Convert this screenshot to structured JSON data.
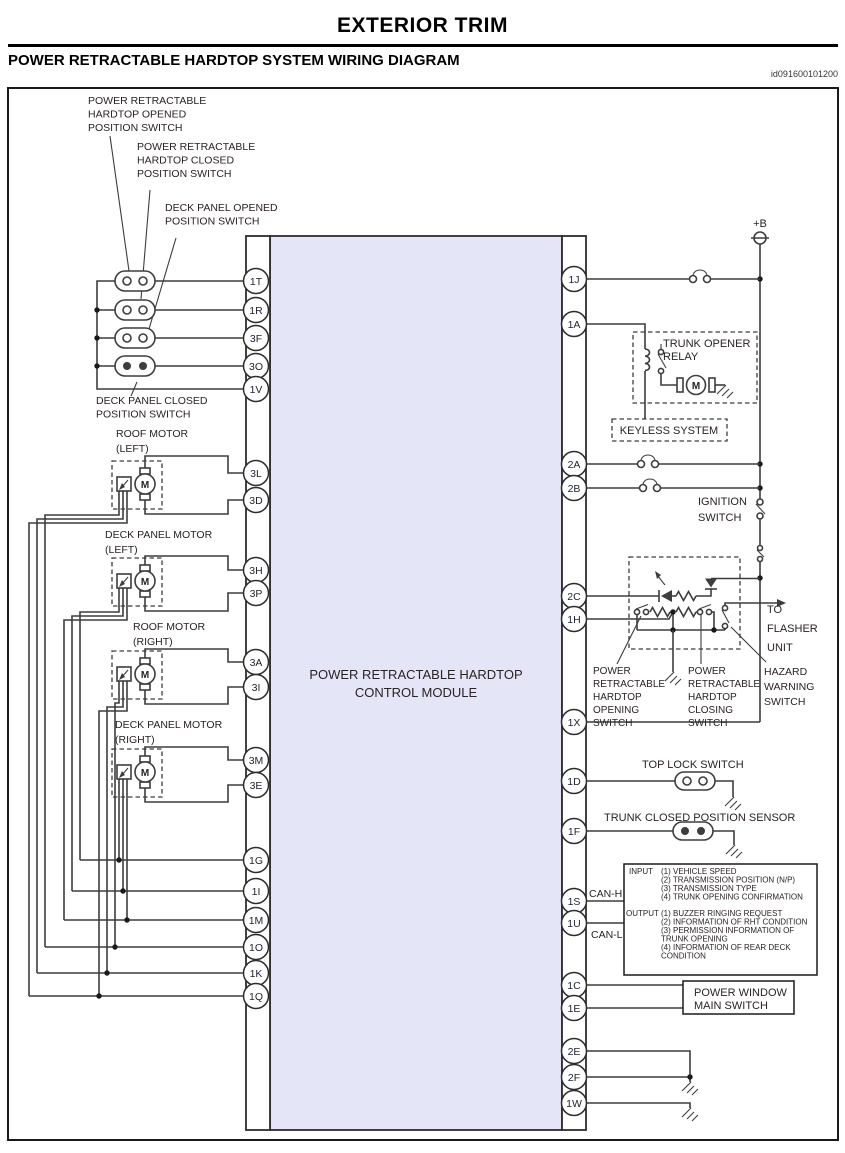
{
  "header": {
    "title": "EXTERIOR TRIM",
    "subtitle": "POWER RETRACTABLE HARDTOP SYSTEM WIRING DIAGRAM",
    "doc_id": "id091600101200"
  },
  "module": {
    "line1": "POWER RETRACTABLE HARDTOP",
    "line2": "CONTROL MODULE"
  },
  "pins": {
    "left": [
      "1T",
      "1R",
      "3F",
      "3O",
      "1V",
      "3L",
      "3D",
      "3H",
      "3P",
      "3A",
      "3I",
      "3M",
      "3E",
      "1G",
      "1I",
      "1M",
      "1O",
      "1K",
      "1Q"
    ],
    "right": [
      "1J",
      "1A",
      "2A",
      "2B",
      "2C",
      "1H",
      "1X",
      "1D",
      "1F",
      "1S",
      "1U",
      "1C",
      "1E",
      "2E",
      "2F",
      "1W"
    ]
  },
  "left_labels": {
    "hardtop_opened": [
      "POWER RETRACTABLE",
      "HARDTOP OPENED",
      "POSITION SWITCH"
    ],
    "hardtop_closed": [
      "POWER RETRACTABLE",
      "HARDTOP CLOSED",
      "POSITION SWITCH"
    ],
    "deck_opened": [
      "DECK PANEL OPENED",
      "POSITION SWITCH"
    ],
    "deck_closed": [
      "DECK PANEL CLOSED",
      "POSITION SWITCH"
    ],
    "roof_motor_left": [
      "ROOF MOTOR",
      "(LEFT)"
    ],
    "deck_motor_left": [
      "DECK PANEL MOTOR",
      "(LEFT)"
    ],
    "roof_motor_right": [
      "ROOF MOTOR",
      "(RIGHT)"
    ],
    "deck_motor_right": [
      "DECK PANEL MOTOR",
      "(RIGHT)"
    ],
    "motor_symbol": "M"
  },
  "right_labels": {
    "battery": "+B",
    "trunk_relay": [
      "TRUNK OPENER",
      "RELAY"
    ],
    "keyless": "KEYLESS SYSTEM",
    "ignition": [
      "IGNITION",
      "SWITCH"
    ],
    "flasher": [
      "TO",
      "FLASHER",
      "UNIT"
    ],
    "opening_switch": [
      "POWER",
      "RETRACTABLE",
      "HARDTOP",
      "OPENING",
      "SWITCH"
    ],
    "closing_switch": [
      "POWER",
      "RETRACTABLE",
      "HARDTOP",
      "CLOSING",
      "SWITCH"
    ],
    "hazard_switch": [
      "HAZARD",
      "WARNING",
      "SWITCH"
    ],
    "top_lock": "TOP LOCK SWITCH",
    "trunk_sensor": "TRUNK CLOSED POSITION SENSOR",
    "can_h": "CAN-H",
    "can_l": "CAN-L",
    "power_window": [
      "POWER WINDOW",
      "MAIN SWITCH"
    ],
    "relay_motor_symbol": "M"
  },
  "can_box": {
    "input_label": "INPUT",
    "input_items": [
      "(1) VEHICLE SPEED",
      "(2) TRANSMISSION POSITION (N/P)",
      "(3) TRANSMISSION TYPE",
      "(4) TRUNK OPENING CONFIRMATION"
    ],
    "output_label": "OUTPUT",
    "output_items": [
      "(1) BUZZER RINGING REQUEST",
      "(2) INFORMATION OF RHT CONDITION",
      "(3) PERMISSION INFORMATION OF",
      "TRUNK OPENING",
      "(4) INFORMATION OF REAR DECK",
      "CONDITION"
    ]
  },
  "colors": {
    "module_fill": "#e4e5f7",
    "wire": "#3d3d3d",
    "text": "#2a2226"
  }
}
